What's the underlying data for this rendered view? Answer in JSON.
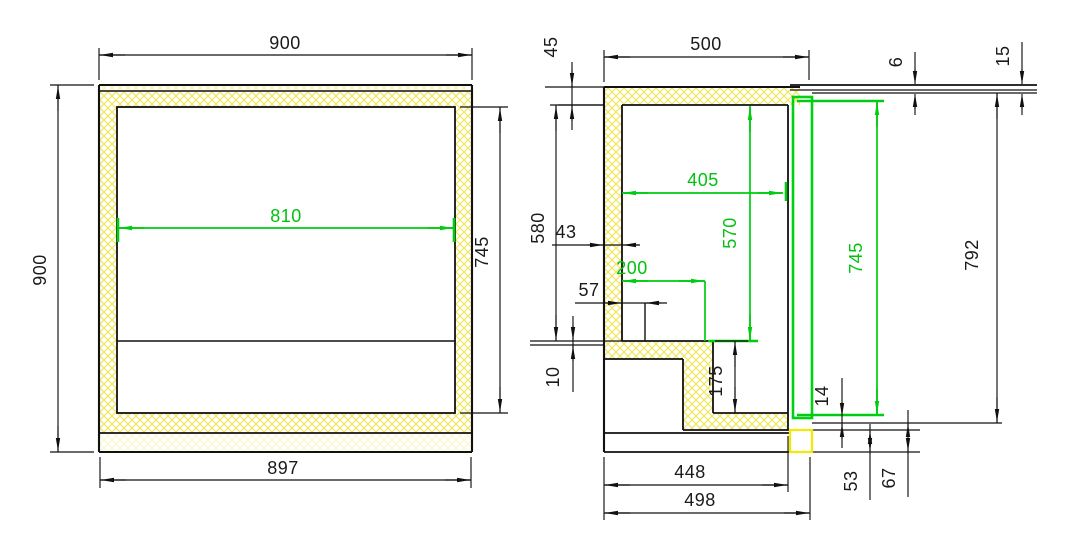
{
  "front_view": {
    "overall_width": "900",
    "overall_height": "900",
    "interior_width": "810",
    "interior_height": "745",
    "base_width": "897"
  },
  "side_view": {
    "top_wall_thickness": "45",
    "overall_depth": "500",
    "worktop_thickness": "6",
    "worktop_edge": "15",
    "interior_depth": "405",
    "interior_height_upper": "570",
    "back_wall_thickness": "43",
    "step_depth": "200",
    "inner_offset": "57",
    "upper_cavity_height": "580",
    "liner_gap": "10",
    "step_height": "175",
    "door_height": "745",
    "overall_height": "792",
    "door_bottom_gap": "14",
    "recess_depth": "448",
    "base_depth": "498",
    "base_gap": "53",
    "base_height": "67"
  },
  "colors": {
    "dimension_accent_green": "#00cc11",
    "insulation_hatch_yellow": "#f0e95f",
    "highlight_yellow": "#f2ea00",
    "line_black": "#111111"
  }
}
